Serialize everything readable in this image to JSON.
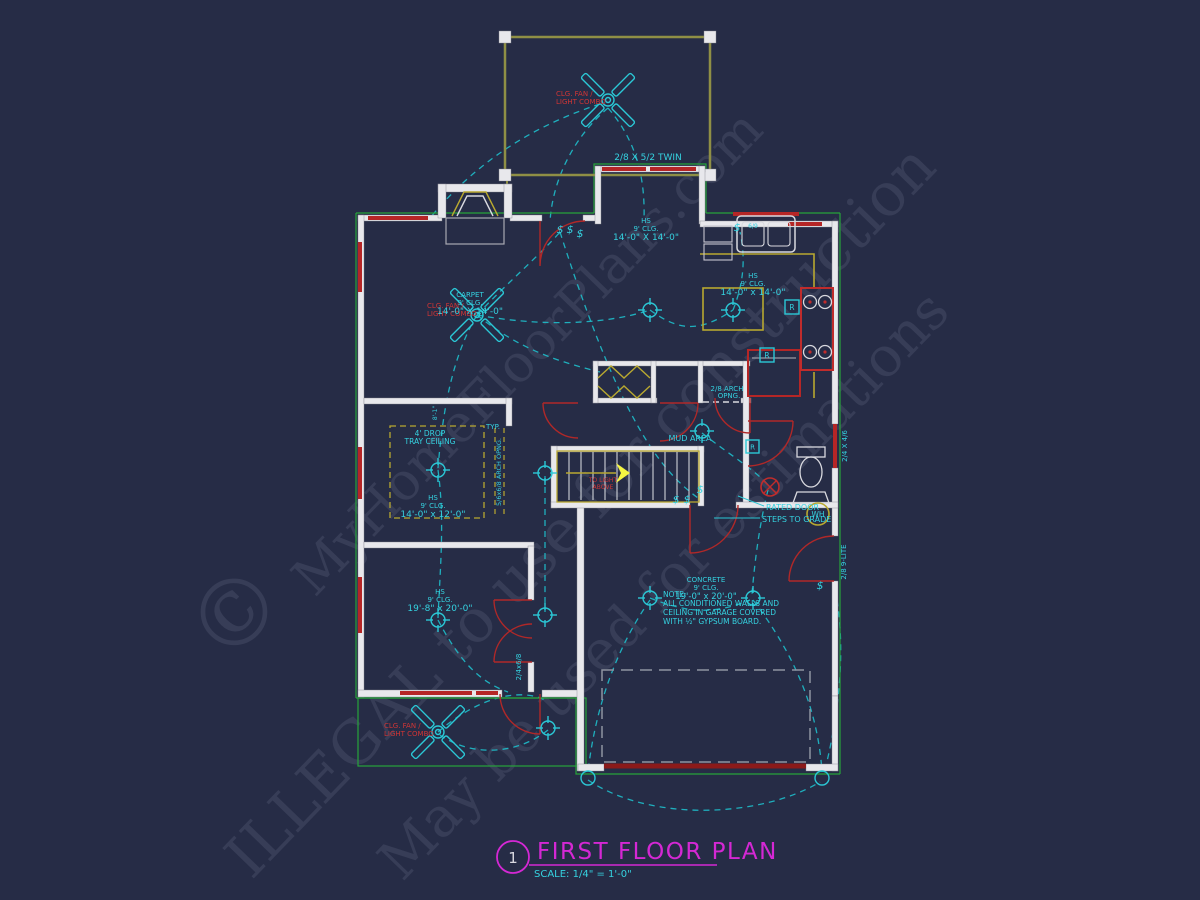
{
  "title_block": {
    "sheet_number": "1",
    "title": "FIRST FLOOR PLAN",
    "scale": "SCALE: 1/4\" = 1'-0\""
  },
  "watermarks": {
    "copyright": "©",
    "brand": "MyHomeFloorPlans.com",
    "warning": "ILLEGAL to use for construction",
    "permission": "May be used for estimations"
  },
  "colors": {
    "background": "#262c46",
    "wall_fill": "#e8e8ec",
    "cyan_text": "#35d2e0",
    "wiring": "#1fb6c4",
    "red_label": "#d03535",
    "door_red": "#b02828",
    "garage_door_red": "#8b1a1a",
    "counter_yellow": "#b8a830",
    "exterior_green": "#27a33b",
    "title_magenta": "#d428d4",
    "watermark_gray": "#9aa0b8"
  },
  "rooms": {
    "nook": {
      "surface": "HS",
      "ceiling": "9' CLG.",
      "dim": "14'-0\" X 14'-0\""
    },
    "living": {
      "surface": "CARPET",
      "ceiling": "9' CLG.",
      "dim": "14'-0\" X 14'-0\""
    },
    "kitchen": {
      "surface": "HS",
      "ceiling": "9' CLG.",
      "dim": "14'-0\" x 14'-0\""
    },
    "bedroom": {
      "surface": "HS",
      "ceiling": "9' CLG.",
      "dim": "14'-0\" x 12'-0\""
    },
    "bonus": {
      "surface": "HS",
      "ceiling": "9' CLG.",
      "dim": "19'-8\" x 20'-0\""
    },
    "garage": {
      "surface": "CONCRETE",
      "ceiling": "9' CLG.",
      "dim": "19'-0\" x 20'-0\""
    },
    "mud": {
      "name": "MUD AREA"
    }
  },
  "labels": {
    "fan_line1": "CLG. FAN /",
    "fan_line2": "LIGHT COMBO",
    "twin_window": "2/8 X 5/2 TWIN",
    "tray_line1": "4' DROP",
    "tray_line2": "TRAY CEILING",
    "typ": "TYP.",
    "arch_side": "5/6x6/8 ARCH OPNG.",
    "arch_line1": "2/8 ARCH",
    "arch_line2": "OPNG.",
    "rated_door": "RATED DOOR",
    "steps": "STEPS TO GRADE",
    "window_24x46": "2/4 X 4/6",
    "door_9lite": "2/8 9-LITE",
    "door_24x68": "2/4x6/8",
    "dim_8_1": "8'-1\"",
    "sink_tag": "6/9",
    "wh": "WH",
    "stair_note1": "TO LIGHT",
    "stair_note2": "ABOVE",
    "note1": "NOTE:",
    "note2": "ALL CONDITIONED WALLS AND",
    "note3": "CEILING IN GARAGE COVERED",
    "note4": "WITH ½\" GYPSUM BOARD."
  },
  "symbols": {
    "switch": "$",
    "receptacle": "R"
  }
}
